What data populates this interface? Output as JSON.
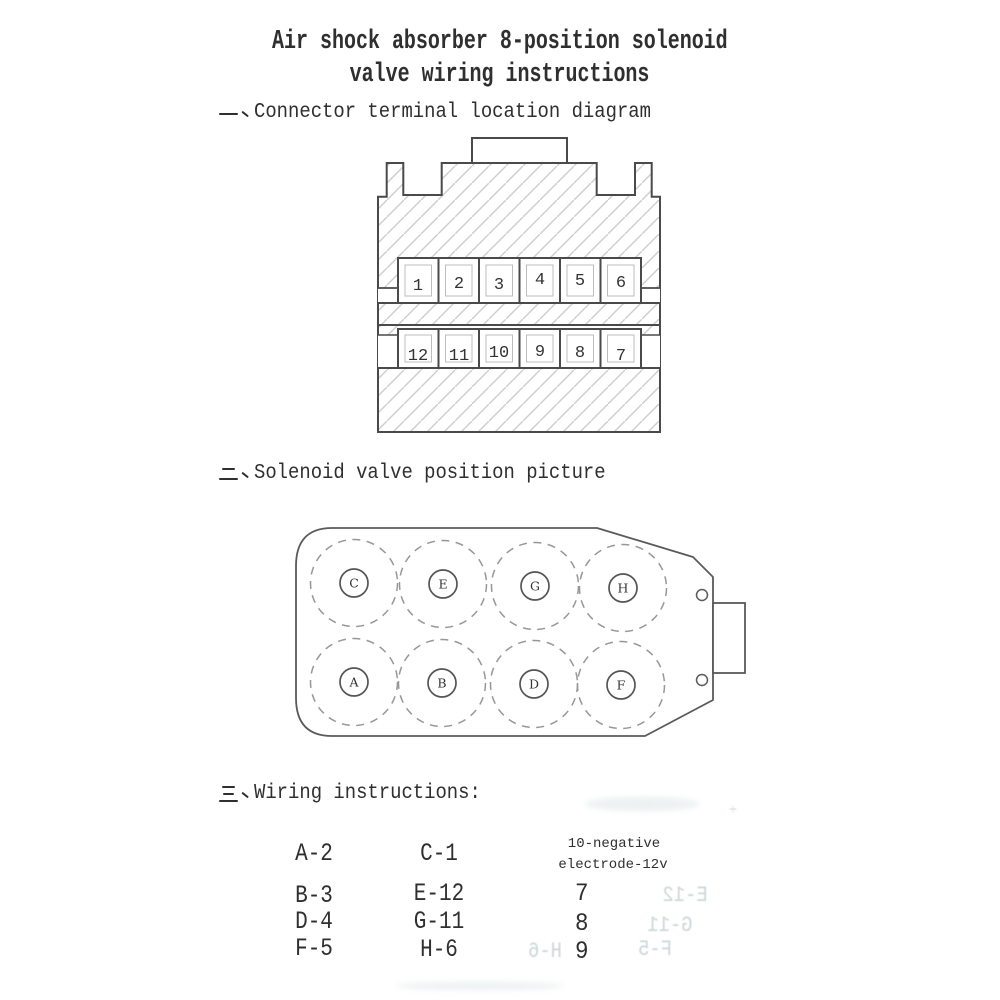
{
  "title": {
    "line1": "Air shock absorber 8-position solenoid",
    "line2": "valve wiring instructions"
  },
  "sections": [
    {
      "num_cjk": "一、",
      "heading": "Connector terminal location diagram"
    },
    {
      "num_cjk": "二、",
      "heading": "Solenoid valve position picture"
    },
    {
      "num_cjk": "三、",
      "heading": "Wiring instructions:"
    }
  ],
  "connector": {
    "top_row": [
      "1",
      "2",
      "3",
      "4",
      "5",
      "6"
    ],
    "bottom_row": [
      "12",
      "11",
      "10",
      "9",
      "8",
      "7"
    ]
  },
  "valve": {
    "top_row": [
      "C",
      "E",
      "G",
      "H"
    ],
    "bottom_row": [
      "A",
      "B",
      "D",
      "F"
    ]
  },
  "wiring": {
    "col1": [
      "A-2",
      "B-3",
      "D-4",
      "F-5"
    ],
    "col2": [
      "C-1",
      "E-12",
      "G-11",
      "H-6"
    ],
    "col3_note_line1": "10-negative",
    "col3_note_line2": "electrode-12v",
    "col3": [
      "7",
      "8",
      "9"
    ]
  },
  "ghost_marks": [
    "E-12",
    "G-11",
    "H-6",
    "F-5",
    "÷"
  ],
  "colors": {
    "paper": "#ffffff",
    "ink": "#2f2f2f",
    "line": "#4a4a4a",
    "hatch": "#cdcdcd",
    "dashed_circle": "#979797",
    "ghost": "#ccd5d8"
  }
}
